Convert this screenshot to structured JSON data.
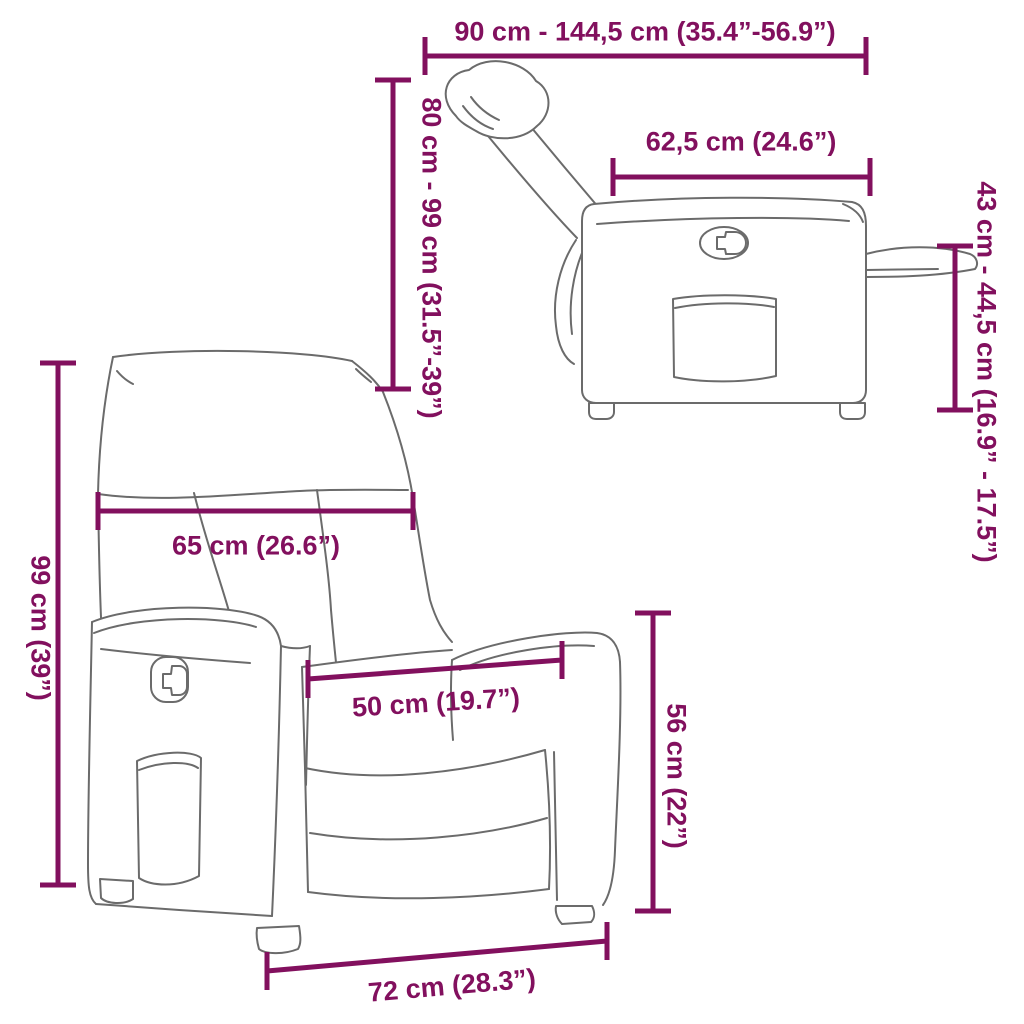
{
  "colors": {
    "dimension_accent": "#82105E",
    "line_art": "#6b6b6b",
    "background": "#ffffff"
  },
  "dimensions": {
    "total_length": "90 cm - 144,5 cm (35.4”-56.9”)",
    "reclined_height": "80 cm - 99 cm (31.5”-39”)",
    "seat_depth": "62,5 cm (24.6”)",
    "footrest_height": "43 cm - 44,5 cm (16.9” - 17.5”)",
    "total_height": "99 cm (39”)",
    "backrest_width": "65 cm (26.6”)",
    "seat_width": "50 cm (19.7”)",
    "seat_height": "56 cm (22”)",
    "base_width": "72 cm (28.3”)"
  }
}
